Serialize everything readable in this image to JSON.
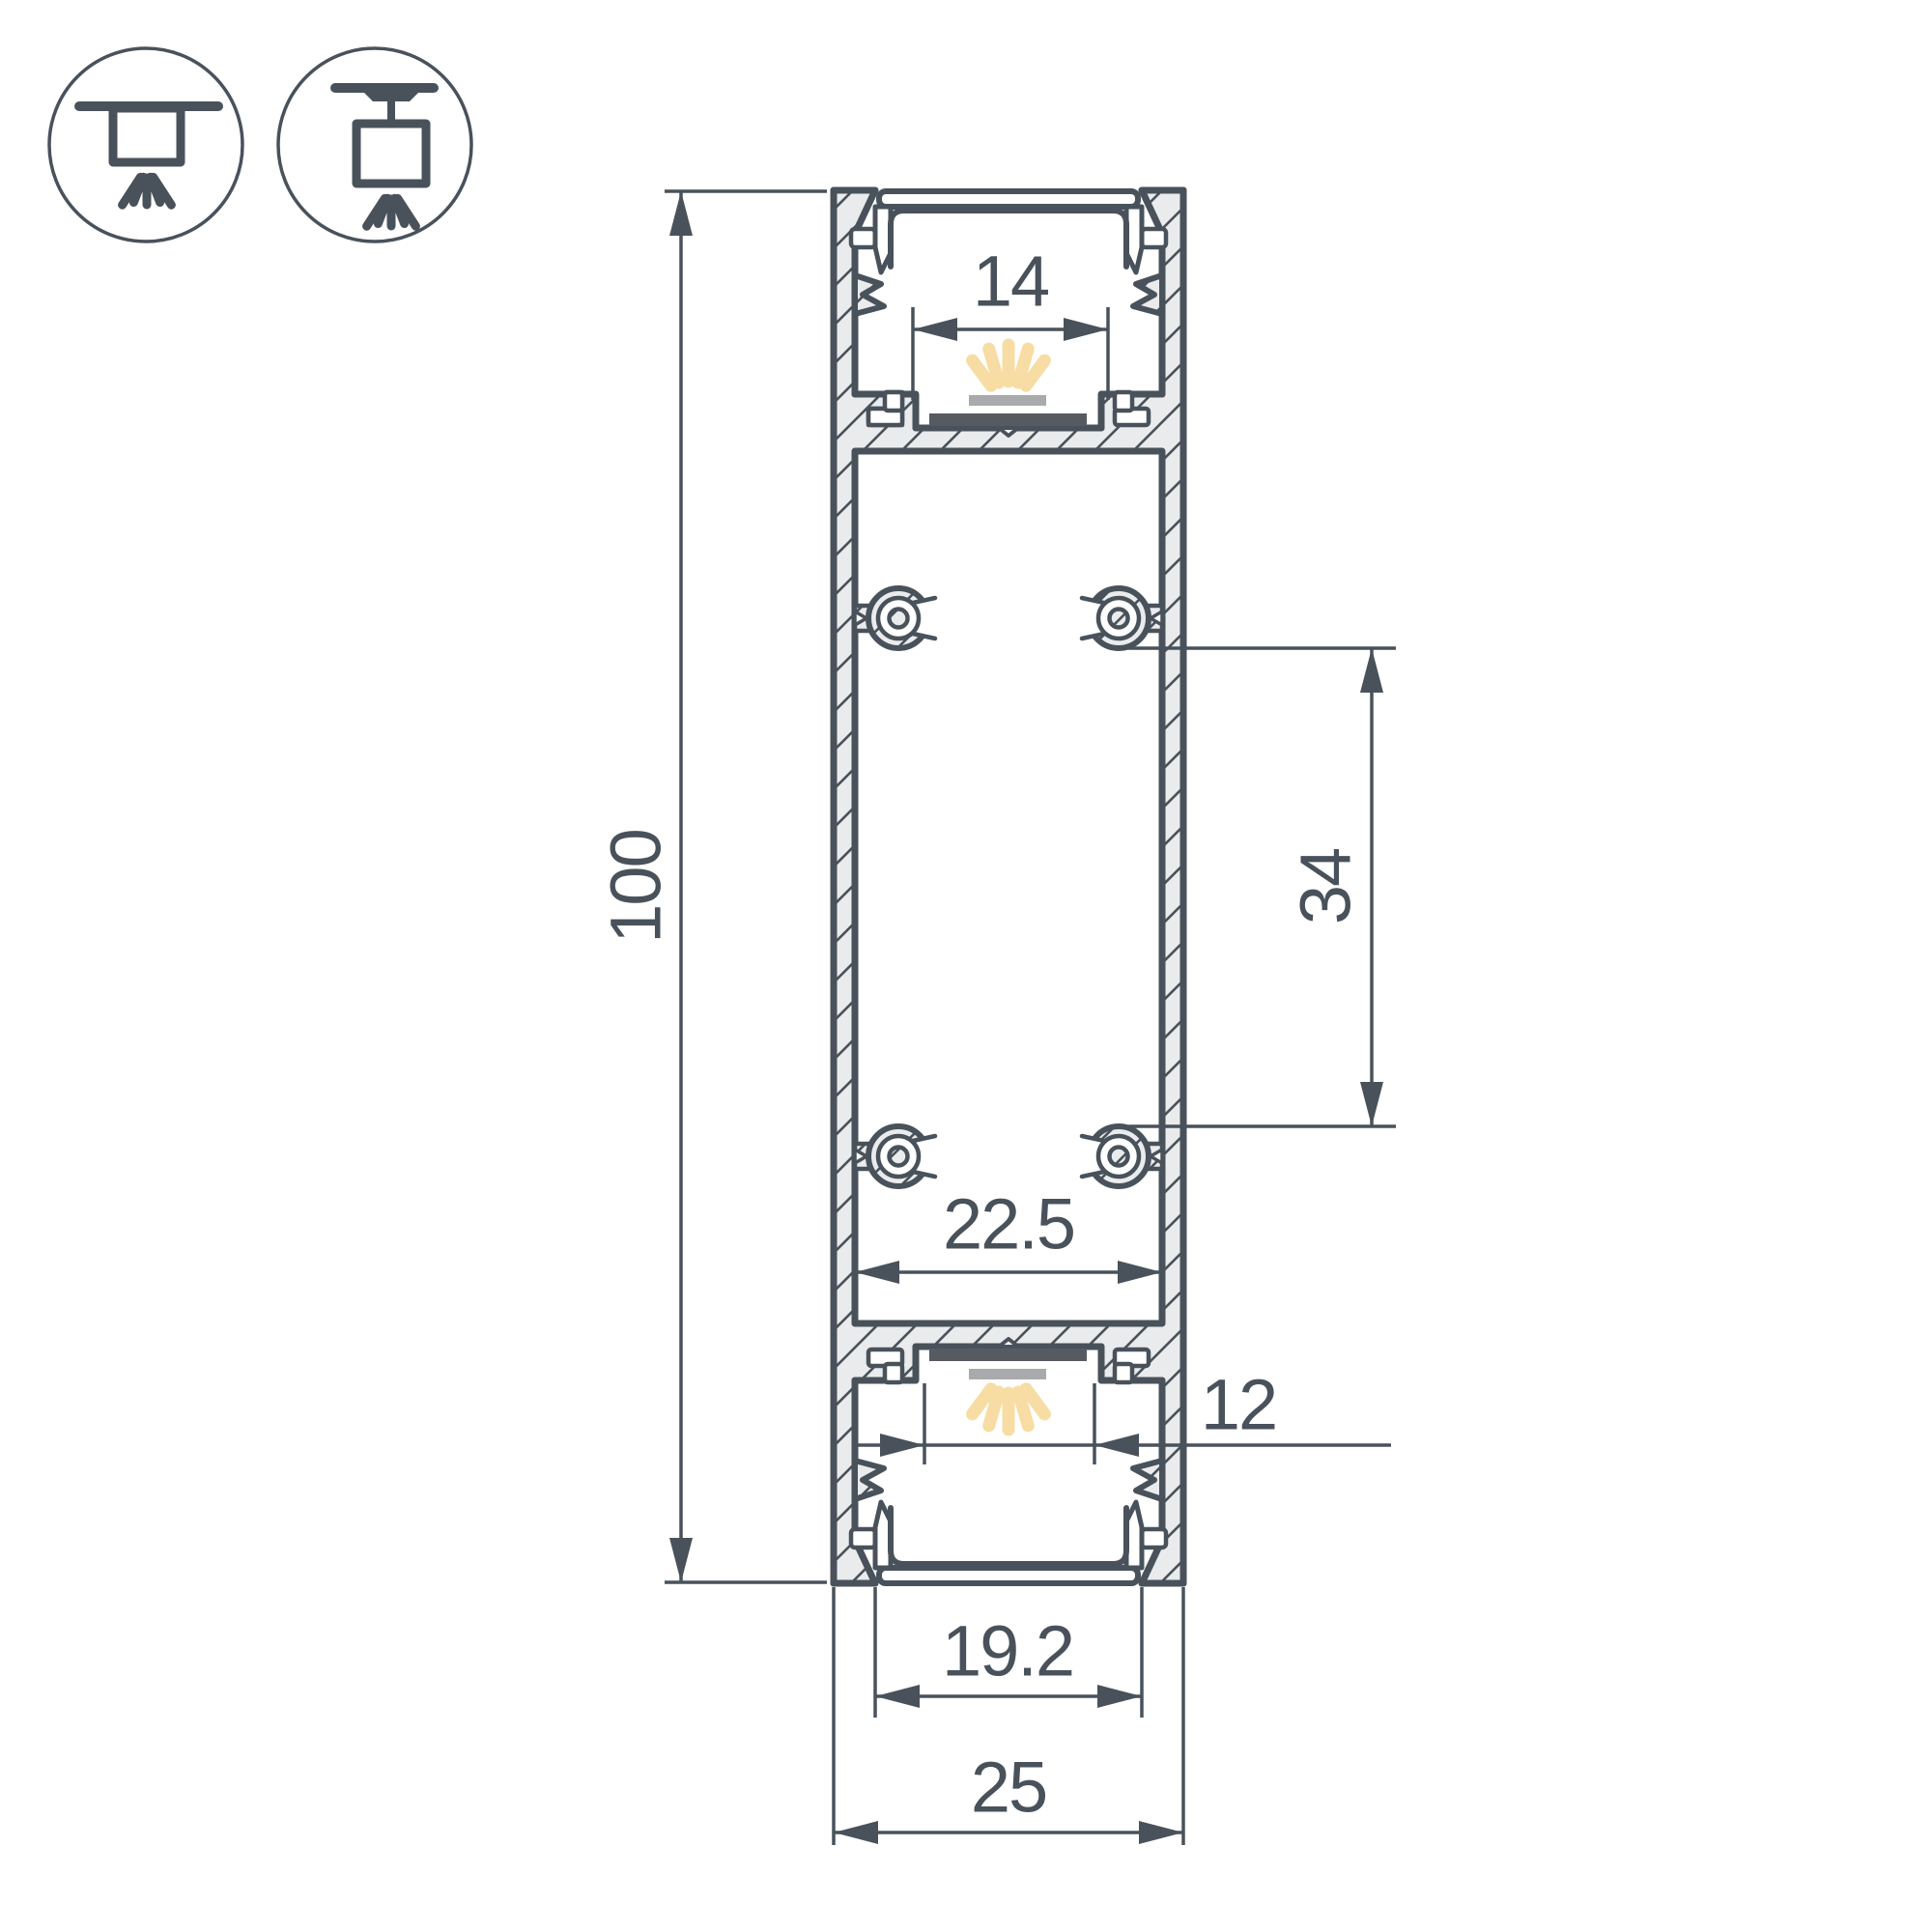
{
  "drawing": {
    "kind": "technical cross-section drawing",
    "subject": "double-sided LED aluminium profile, vertical cross-section with dimensions"
  },
  "icons": [
    {
      "name": "surface-ceiling-mount-icon",
      "meaning": "surface mounted luminaire"
    },
    {
      "name": "pendant-suspension-mount-icon",
      "meaning": "suspended / pendant luminaire"
    }
  ],
  "dims": {
    "height": {
      "label": "100",
      "meaning": "overall profile height, mm"
    },
    "top_window": {
      "label": "14",
      "meaning": "top LED strip seat width, mm"
    },
    "boss_span": {
      "label": "34",
      "meaning": "distance between screw bosses, mm"
    },
    "inner_width": {
      "label": "22.5",
      "meaning": "inner chamber width, mm"
    },
    "bottom_window": {
      "label": "12",
      "meaning": "bottom LED strip seat width, mm"
    },
    "bottom_opening": {
      "label": "19.2",
      "meaning": "bottom opening width, mm"
    },
    "overall_width": {
      "label": "25",
      "meaning": "overall profile width, mm"
    }
  },
  "colors": {
    "outline": "#49525b",
    "metal_fill": "#eaebed",
    "led_glow": "#f7dda3",
    "led_pad": "#a9aaac",
    "led_pcb": "#565b62"
  }
}
